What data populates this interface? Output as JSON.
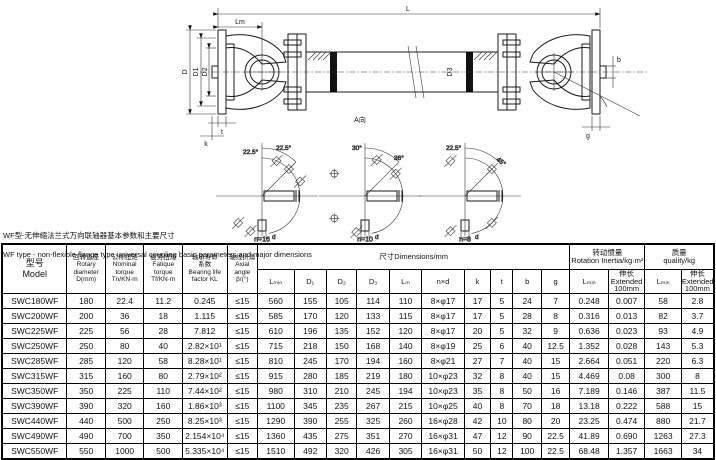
{
  "title": {
    "line1_zh": "WF型-无伸缩法兰式万向联轴器基本参数和主要尺寸",
    "line2_en": "WF type - non-flexible flange type universal coupling basic parameters and major dimensions"
  },
  "drawing": {
    "dims": {
      "L": "L",
      "Lm": "Lm",
      "D": "D",
      "D1": "D1",
      "D2": "D2",
      "D3": "D3",
      "t": "t",
      "k": "k",
      "g": "g",
      "b": "b"
    },
    "view_label": "A向",
    "views": [
      {
        "label": "n=16",
        "angle_a": "22.5°",
        "angle_b": "22.5°",
        "shaft_dim": "d",
        "circle_dim": "D3"
      },
      {
        "label": "n=10",
        "angle_a": "30°",
        "angle_b": "36°",
        "shaft_dim": "d",
        "circle_dim": "D3"
      },
      {
        "label": "n=8",
        "angle_a": "22.5°",
        "angle_b": "45°",
        "shaft_dim": "d",
        "circle_dim": "D3"
      }
    ]
  },
  "table": {
    "headers": {
      "model": "型号\nModel",
      "rotary": "回转直径\nRotary\ndiameter\nD(mm)",
      "nominal": "公称扭矩\nNominal\ntorque\nTn/KN·m",
      "fatigue": "疲劳扭矩\nFatique\ntorque\nTf/KN·m",
      "bearing": "轴承寿命\n系数\nBearing life\nfactor  KL",
      "axial": "轴线折角\nAxial angle\nβ/(°)",
      "dims_group": "尺寸Dimensions/mm",
      "inertia_group": "转动惯量\nRotation Inertia/kg·m²",
      "quality_group": "质量\nquality/kg",
      "dim_cols": [
        "Lₘᵢₙ",
        "D₁",
        "D₂",
        "D₃",
        "Lₘ",
        "n×d",
        "k",
        "t",
        "b",
        "g"
      ],
      "lmin": "Lₘᵢₙ",
      "extended": "伸长\nExtended\n100mm"
    },
    "rows": [
      [
        "SWC180WF",
        "180",
        "22.4",
        "11.2",
        "0.245",
        "≤15",
        "560",
        "155",
        "105",
        "114",
        "110",
        "8×φ17",
        "17",
        "5",
        "24",
        "7",
        "0.248",
        "0.007",
        "58",
        "2.8"
      ],
      [
        "SWC200WF",
        "200",
        "36",
        "18",
        "1.115",
        "≤15",
        "585",
        "170",
        "120",
        "133",
        "115",
        "8×φ17",
        "17",
        "5",
        "28",
        "8",
        "0.316",
        "0.013",
        "82",
        "3.7"
      ],
      [
        "SWC225WF",
        "225",
        "56",
        "28",
        "7.812",
        "≤15",
        "610",
        "196",
        "135",
        "152",
        "120",
        "8×φ17",
        "20",
        "5",
        "32",
        "9",
        "0.636",
        "0.023",
        "93",
        "4.9"
      ],
      [
        "SWC250WF",
        "250",
        "80",
        "40",
        "2.82×10¹",
        "≤15",
        "715",
        "218",
        "150",
        "168",
        "140",
        "8×φ19",
        "25",
        "6",
        "40",
        "12.5",
        "1.352",
        "0.028",
        "143",
        "5.3"
      ],
      [
        "SWC285WF",
        "285",
        "120",
        "58",
        "8.28×10¹",
        "≤15",
        "810",
        "245",
        "170",
        "194",
        "160",
        "8×φ21",
        "27",
        "7",
        "40",
        "15",
        "2.664",
        "0.051",
        "220",
        "6.3"
      ],
      [
        "SWC315WF",
        "315",
        "160",
        "80",
        "2.79×10²",
        "≤15",
        "915",
        "280",
        "185",
        "219",
        "180",
        "10×φ23",
        "32",
        "8",
        "40",
        "15",
        "4.469",
        "0.08",
        "300",
        "8"
      ],
      [
        "SWC350WF",
        "350",
        "225",
        "110",
        "7.44×10²",
        "≤15",
        "980",
        "310",
        "210",
        "245",
        "194",
        "10×φ23",
        "35",
        "8",
        "50",
        "16",
        "7.189",
        "0.146",
        "387",
        "11.5"
      ],
      [
        "SWC390WF",
        "390",
        "320",
        "160",
        "1.86×10³",
        "≤15",
        "1100",
        "345",
        "235",
        "267",
        "215",
        "10×φ25",
        "40",
        "8",
        "70",
        "18",
        "13.18",
        "0.222",
        "588",
        "15"
      ],
      [
        "SWC440WF",
        "440",
        "500",
        "250",
        "8.25×10³",
        "≤15",
        "1290",
        "390",
        "255",
        "325",
        "260",
        "16×φ28",
        "42",
        "10",
        "80",
        "20",
        "23.25",
        "0.474",
        "880",
        "21.7"
      ],
      [
        "SWC490WF",
        "490",
        "700",
        "350",
        "2.154×10⁴",
        "≤15",
        "1360",
        "435",
        "275",
        "351",
        "270",
        "16×φ31",
        "47",
        "12",
        "90",
        "22.5",
        "41.89",
        "0.690",
        "1263",
        "27.3"
      ],
      [
        "SWC550WF",
        "550",
        "1000",
        "500",
        "5.335×10⁴",
        "≤15",
        "1510",
        "492",
        "320",
        "426",
        "305",
        "16×φ31",
        "50",
        "12",
        "100",
        "22.5",
        "68.48",
        "1.357",
        "1663",
        "34"
      ]
    ]
  }
}
